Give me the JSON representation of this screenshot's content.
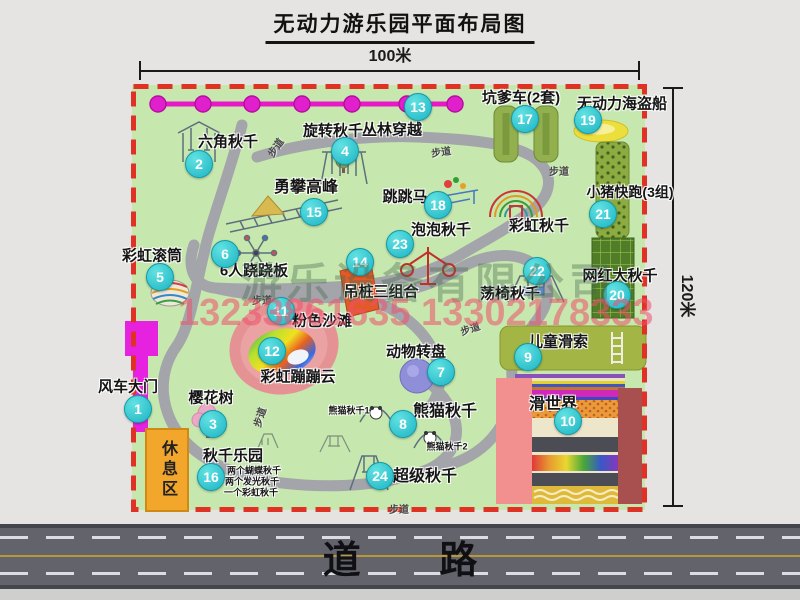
{
  "title": "无动力游乐园平面布局图",
  "dimensions": {
    "width": "100米",
    "height": "120米"
  },
  "road_label": "道 路",
  "path_label": "步道",
  "rest_area_label": "休息区",
  "watermark": {
    "company": "游乐设备有限公司",
    "phone": "13233861635 13302178333"
  },
  "markers": [
    {
      "num": "1",
      "label": "风车大门"
    },
    {
      "num": "2",
      "label": "六角秋千"
    },
    {
      "num": "3",
      "label": "樱花树"
    },
    {
      "num": "4",
      "label": "旋转秋千"
    },
    {
      "num": "5",
      "label": "彩虹滚筒"
    },
    {
      "num": "6",
      "label": "6人跷跷板"
    },
    {
      "num": "7",
      "label": "动物转盘"
    },
    {
      "num": "8",
      "label": "熊猫秋千"
    },
    {
      "num": "9",
      "label": "儿童滑索"
    },
    {
      "num": "10",
      "label": "滑世界"
    },
    {
      "num": "11",
      "label": "粉色沙滩"
    },
    {
      "num": "12",
      "label": "彩虹蹦蹦云"
    },
    {
      "num": "13",
      "label": "丛林穿越"
    },
    {
      "num": "14",
      "label": "吊桩三组合"
    },
    {
      "num": "15",
      "label": "勇攀高峰"
    },
    {
      "num": "16",
      "label": "秋千乐园"
    },
    {
      "num": "17",
      "label": "坑爹车(2套)"
    },
    {
      "num": "18",
      "label": "跳跳马"
    },
    {
      "num": "19",
      "label": "无动力海盗船"
    },
    {
      "num": "20",
      "label": "网红大秋千"
    },
    {
      "num": "21",
      "label": "小猪快跑(3组)"
    },
    {
      "num": "22",
      "label": "荡椅秋千"
    },
    {
      "num": "23",
      "label": "泡泡秋千"
    },
    {
      "num": "24",
      "label": "超级秋千"
    }
  ],
  "extra_labels": [
    {
      "text": "彩虹秋千"
    },
    {
      "text": "熊猫秋千1"
    },
    {
      "text": "熊猫秋千2"
    },
    {
      "text": "两个蝴蝶秋千"
    },
    {
      "text": "两个发光秋千"
    },
    {
      "text": "一个彩虹秋千"
    }
  ],
  "colors": {
    "map_green": "#c6e7ae",
    "border_red": "#e03224",
    "badge_teal": "#1cb4c4",
    "gate_magenta": "#e621e0",
    "zipline_magenta": "#e818c8",
    "rest_orange": "#f2a62c",
    "road_gray": "#63636b"
  }
}
